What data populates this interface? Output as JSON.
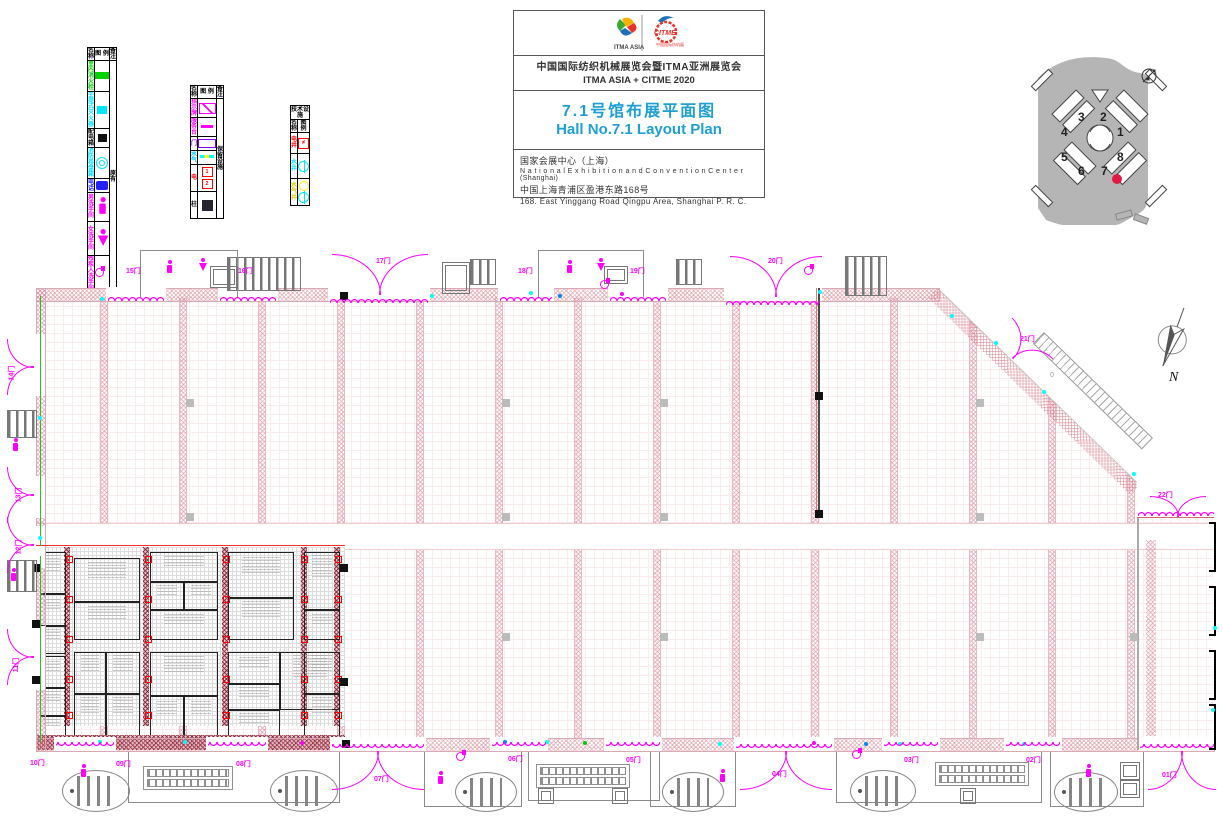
{
  "title_block": {
    "logo1": "ITMA ASIA",
    "logo2": "CITME",
    "line1_cn": "中国国际纺织机械展览会暨ITMA亚洲展览会",
    "line2_en": "ITMA ASIA + CITME 2020",
    "hall_cn": "7.1号馆布展平面图",
    "hall_en": "Hall No.7.1 Layout Plan",
    "venue_cn": "国家会展中心（上海）",
    "venue_en": "N a t i o n a l  E x h i b i t i o n  a n d  C o n v e n t i o n  C e n t e r  (Shanghai)",
    "addr_cn": "中国上海青浦区盈港东路168号",
    "addr_en": "168. East Yinggang Road Qingpu Area, Shanghai P. R. C."
  },
  "compass_label": "N",
  "ramp_marker": "0",
  "legend": {
    "t1": {
      "h1": "名  称",
      "h2": "图  例",
      "h3": "备 注",
      "remark": "原 有",
      "rows": [
        {
          "t": "室内消火栓",
          "c": "#00d400",
          "icon": "greenbox",
          "h": 11
        },
        {
          "t": "手提式灭火器",
          "c": "#00e5ff",
          "icon": "cyanbox",
          "h": 11
        },
        {
          "t": "配电箱",
          "c": "#111111",
          "icon": "blackbox",
          "h": 11
        },
        {
          "t": "消防卷盘箱",
          "c": "#00e5ff",
          "icon": "coil",
          "h": 13
        },
        {
          "t": "电话",
          "c": "#2222ff",
          "icon": "phone",
          "h": 13
        },
        {
          "t": "男洗手间",
          "c": "#ff00ff",
          "icon": "man",
          "h": 28
        },
        {
          "t": "女洗手间",
          "c": "#ff00ff",
          "icon": "woman",
          "h": 33
        },
        {
          "t": "残疾人洗手间",
          "c": "#ff00ff",
          "icon": "wheelchair",
          "h": 31
        }
      ]
    },
    "t2": {
      "h1": "名  称",
      "h2": "图  例",
      "h3": "备 注",
      "remark": "保留设施",
      "rows": [
        {
          "t": "指示牌",
          "c": "#ff00ff",
          "icon": "sign",
          "h": 16
        },
        {
          "t": "服务台",
          "c": "#ff00ff",
          "icon": "dashM",
          "h": 13
        },
        {
          "t": "门",
          "c": "#8000ff",
          "icon": "doorP",
          "h": 13
        },
        {
          "t": "水气",
          "c": "#00c8ff",
          "icon": "wg",
          "h": 13
        },
        {
          "t": "电",
          "c": "#ff0000",
          "icon": "elec2",
          "h": 26
        },
        {
          "t": "柱",
          "c": "#111111",
          "icon": "colblk",
          "h": 26
        }
      ]
    },
    "t3": {
      "title": "技术设施",
      "h1": "名 称",
      "h2": "图 例",
      "rows": [
        {
          "t": "电井",
          "c": "#ff0000",
          "icon": "wellE",
          "h": 20
        },
        {
          "t": "水井",
          "c": "#00e5ff",
          "icon": "wellW",
          "h": 24
        },
        {
          "t": "水气井",
          "c": "#ddcc00",
          "icon": "wellWG",
          "h": 26
        }
      ]
    }
  },
  "site_map": {
    "highlight_hall": "7",
    "red": "#e11a45",
    "halls": [
      {
        "n": "3",
        "x": 50,
        "y": 60
      },
      {
        "n": "2",
        "x": 72,
        "y": 60
      },
      {
        "n": "4",
        "x": 33,
        "y": 75
      },
      {
        "n": "1",
        "x": 89,
        "y": 75
      },
      {
        "n": "5",
        "x": 33,
        "y": 100
      },
      {
        "n": "8",
        "x": 89,
        "y": 100
      },
      {
        "n": "6",
        "x": 50,
        "y": 114
      },
      {
        "n": "7",
        "x": 73,
        "y": 114
      }
    ],
    "red_dot": {
      "x": 84,
      "y": 124
    }
  },
  "plan": {
    "door_labels": [
      [
        "15门",
        126,
        266,
        0
      ],
      [
        "16门",
        238,
        266,
        0
      ],
      [
        "17门",
        376,
        256,
        0
      ],
      [
        "18门",
        518,
        266,
        0
      ],
      [
        "19门",
        630,
        266,
        0
      ],
      [
        "20门",
        768,
        256,
        0
      ],
      [
        "21门",
        1020,
        334,
        0
      ],
      [
        "22门",
        1158,
        490,
        0
      ],
      [
        "10门",
        30,
        758,
        0
      ],
      [
        "09门",
        116,
        759,
        0
      ],
      [
        "08门",
        236,
        759,
        0
      ],
      [
        "07门",
        374,
        774,
        0
      ],
      [
        "06门",
        508,
        754,
        0
      ],
      [
        "05门",
        626,
        755,
        0
      ],
      [
        "04门",
        772,
        769,
        0
      ],
      [
        "03门",
        904,
        755,
        0
      ],
      [
        "02门",
        1026,
        755,
        0
      ],
      [
        "01门",
        1162,
        770,
        0
      ],
      [
        "14门",
        4,
        368,
        -90
      ],
      [
        "13门",
        11,
        490,
        -90
      ],
      [
        "12门",
        11,
        542,
        -90
      ],
      [
        "11门",
        9,
        660,
        -90
      ]
    ],
    "arc_doors": [
      [
        332,
        254,
        96,
        40,
        0
      ],
      [
        730,
        256,
        92,
        40,
        0
      ],
      [
        994,
        334,
        58,
        28,
        45
      ],
      [
        1150,
        496,
        56,
        20,
        0
      ],
      [
        332,
        752,
        92,
        38,
        180
      ],
      [
        740,
        752,
        92,
        38,
        180
      ],
      [
        1148,
        752,
        68,
        38,
        180
      ],
      [
        -8,
        354,
        56,
        26,
        -90
      ],
      [
        -8,
        482,
        56,
        26,
        -90
      ],
      [
        -8,
        532,
        56,
        26,
        -90
      ],
      [
        -8,
        644,
        56,
        26,
        -90
      ]
    ],
    "scallops": [
      [
        108,
        294,
        56,
        0
      ],
      [
        220,
        294,
        56,
        0
      ],
      [
        330,
        296,
        98,
        0
      ],
      [
        500,
        294,
        52,
        0
      ],
      [
        610,
        294,
        56,
        0
      ],
      [
        726,
        298,
        94,
        0
      ],
      [
        56,
        742,
        58,
        180
      ],
      [
        208,
        742,
        58,
        180
      ],
      [
        332,
        744,
        92,
        180
      ],
      [
        492,
        742,
        54,
        180
      ],
      [
        606,
        742,
        54,
        180
      ],
      [
        736,
        744,
        96,
        180
      ],
      [
        884,
        742,
        54,
        180
      ],
      [
        1006,
        742,
        54,
        180
      ],
      [
        1140,
        744,
        74,
        180
      ],
      [
        1138,
        509,
        76,
        0
      ]
    ],
    "strips_open": [
      64,
      143,
      222,
      301,
      380,
      459,
      538,
      617,
      696,
      775,
      854,
      933,
      1012,
      1091
    ],
    "strips_booth": [
      64,
      143,
      222,
      301,
      334
    ],
    "aisle": [
      0,
      235,
      1177,
      25
    ],
    "columns": [
      [
        186,
        399
      ],
      [
        502,
        399
      ],
      [
        660,
        399
      ],
      [
        976,
        399
      ],
      [
        186,
        513
      ],
      [
        502,
        513
      ],
      [
        660,
        513
      ],
      [
        976,
        513
      ],
      [
        502,
        633
      ],
      [
        660,
        633
      ],
      [
        976,
        633
      ],
      [
        1130,
        633
      ]
    ],
    "blacks": [
      [
        815,
        392
      ],
      [
        815,
        510
      ],
      [
        340,
        292
      ],
      [
        340,
        564
      ],
      [
        340,
        678
      ],
      [
        32,
        564
      ],
      [
        32,
        620
      ],
      [
        32,
        676
      ],
      [
        342,
        740
      ]
    ],
    "lines": [
      [
        36,
        545,
        309,
        1,
        "#ff2a2a"
      ],
      [
        816,
        288,
        1,
        230,
        "#e07979"
      ],
      [
        818,
        288,
        2,
        230,
        "#4a4a4a"
      ],
      [
        40,
        296,
        1,
        250,
        "#23c423"
      ],
      [
        40,
        556,
        1,
        186,
        "#23c423"
      ],
      [
        1137,
        518,
        2,
        232,
        "#a9a9a9"
      ],
      [
        1137,
        517,
        77,
        1,
        "#d66a7d"
      ]
    ],
    "booths": [
      [
        40,
        552,
        24,
        40
      ],
      [
        40,
        594,
        24,
        30
      ],
      [
        40,
        626,
        24,
        26
      ],
      [
        74,
        558,
        64,
        42
      ],
      [
        74,
        602,
        64,
        36
      ],
      [
        150,
        552,
        66,
        28
      ],
      [
        150,
        582,
        32,
        26
      ],
      [
        184,
        582,
        32,
        26
      ],
      [
        150,
        610,
        66,
        28
      ],
      [
        228,
        552,
        64,
        44
      ],
      [
        228,
        598,
        64,
        40
      ],
      [
        304,
        552,
        34,
        56
      ],
      [
        304,
        610,
        34,
        28
      ],
      [
        40,
        656,
        24,
        30
      ],
      [
        40,
        688,
        24,
        26
      ],
      [
        40,
        716,
        24,
        18
      ],
      [
        74,
        652,
        30,
        40
      ],
      [
        106,
        652,
        32,
        40
      ],
      [
        74,
        694,
        30,
        40
      ],
      [
        106,
        694,
        32,
        40
      ],
      [
        150,
        652,
        66,
        42
      ],
      [
        150,
        696,
        32,
        38
      ],
      [
        184,
        696,
        32,
        38
      ],
      [
        228,
        652,
        50,
        30
      ],
      [
        228,
        684,
        50,
        24
      ],
      [
        280,
        652,
        58,
        56
      ],
      [
        228,
        710,
        50,
        24
      ],
      [
        304,
        652,
        34,
        40
      ],
      [
        304,
        694,
        34,
        40
      ]
    ],
    "red_marks": {
      "xs": [
        66,
        145,
        223,
        301,
        335
      ],
      "ys": [
        556,
        596,
        636,
        676,
        712
      ]
    },
    "brackets": [
      [
        1209,
        522,
        46
      ],
      [
        1209,
        586,
        46
      ],
      [
        1209,
        650,
        46
      ],
      [
        1209,
        704,
        42
      ]
    ],
    "furniture": [
      [
        "stairs",
        227,
        257,
        72,
        32
      ],
      [
        "stairs",
        845,
        256,
        40,
        38
      ],
      [
        "stairs",
        470,
        259,
        24,
        24
      ],
      [
        "stairs",
        676,
        259,
        24,
        24
      ],
      [
        "stairs",
        7,
        410,
        28,
        26
      ],
      [
        "stairs",
        7,
        560,
        28,
        30
      ],
      [
        "lobbyT",
        140,
        250,
        96,
        46
      ],
      [
        "lobbyT",
        538,
        250,
        104,
        46
      ],
      [
        "lobbyB",
        128,
        752,
        210,
        50
      ],
      [
        "lobbyB",
        424,
        752,
        96,
        54
      ],
      [
        "lobbyB",
        528,
        752,
        130,
        48
      ],
      [
        "lobbyB",
        650,
        752,
        84,
        54
      ],
      [
        "lobbyB",
        836,
        752,
        204,
        50
      ],
      [
        "lobbyB",
        1050,
        752,
        92,
        54
      ],
      [
        "oval",
        62,
        770,
        66,
        40
      ],
      [
        "oval",
        270,
        770,
        66,
        40
      ],
      [
        "oval",
        455,
        772,
        60,
        38
      ],
      [
        "oval",
        662,
        772,
        60,
        38
      ],
      [
        "oval",
        850,
        770,
        64,
        40
      ],
      [
        "oval",
        1054,
        772,
        62,
        38
      ],
      [
        "esc",
        143,
        766,
        88,
        22
      ],
      [
        "esc",
        536,
        764,
        92,
        22
      ],
      [
        "esc",
        935,
        762,
        92,
        22
      ],
      [
        "elev",
        210,
        266,
        26,
        20
      ],
      [
        "elev",
        604,
        266,
        22,
        16
      ],
      [
        "elev",
        442,
        262,
        26,
        30
      ],
      [
        "elev",
        538,
        788,
        14,
        14
      ],
      [
        "elev",
        612,
        788,
        14,
        14
      ],
      [
        "elev",
        960,
        788,
        14,
        14
      ],
      [
        "elev",
        1120,
        762,
        18,
        16
      ],
      [
        "elev",
        1120,
        780,
        18,
        16
      ]
    ],
    "persons": [
      [
        166,
        260
      ],
      [
        199,
        258
      ],
      [
        566,
        260
      ],
      [
        597,
        258
      ],
      [
        80,
        764
      ],
      [
        437,
        771
      ],
      [
        719,
        769
      ],
      [
        1085,
        764
      ],
      [
        12,
        438
      ],
      [
        10,
        568
      ]
    ],
    "women": [
      [
        199,
        258
      ],
      [
        597,
        258
      ]
    ],
    "wheelchairs": [
      [
        456,
        750
      ],
      [
        852,
        748
      ],
      [
        600,
        278
      ],
      [
        804,
        264
      ]
    ],
    "dots": [
      [
        100,
        297,
        "#0ff"
      ],
      [
        430,
        294,
        "#0ff"
      ],
      [
        529,
        291,
        "#0ff"
      ],
      [
        558,
        294,
        "#08f"
      ],
      [
        620,
        292,
        "#f0f"
      ],
      [
        818,
        290,
        "#0ff"
      ],
      [
        950,
        314,
        "#0ff"
      ],
      [
        994,
        341,
        "#0ff"
      ],
      [
        1042,
        390,
        "#0ff"
      ],
      [
        183,
        740,
        "#0ff"
      ],
      [
        300,
        741,
        "#f0f"
      ],
      [
        503,
        740,
        "#08f"
      ],
      [
        545,
        740,
        "#0ff"
      ],
      [
        583,
        741,
        "#0c0"
      ],
      [
        718,
        742,
        "#0ff"
      ],
      [
        812,
        741,
        "#f0f"
      ],
      [
        864,
        742,
        "#08f"
      ],
      [
        898,
        742,
        "#0ff"
      ],
      [
        1022,
        742,
        "#0ff"
      ],
      [
        1213,
        626,
        "#0ff"
      ],
      [
        1211,
        708,
        "#0ff"
      ],
      [
        38,
        416,
        "#0ff"
      ],
      [
        38,
        536,
        "#0ff"
      ],
      [
        98,
        740,
        "#0ff"
      ],
      [
        1132,
        472,
        "#0ff"
      ]
    ],
    "top_wall": {
      "band": [
        36,
        288,
        902,
        12
      ],
      "gaps": [
        [
          106,
          60
        ],
        [
          218,
          60
        ],
        [
          328,
          102
        ],
        [
          498,
          56
        ],
        [
          608,
          60
        ],
        [
          724,
          98
        ]
      ]
    },
    "bottom_wall": {
      "band": [
        36,
        738,
        1177,
        12
      ],
      "gaps": [
        [
          54,
          62
        ],
        [
          206,
          62
        ],
        [
          330,
          96
        ],
        [
          490,
          58
        ],
        [
          604,
          58
        ],
        [
          734,
          100
        ],
        [
          882,
          58
        ],
        [
          1004,
          58
        ],
        [
          1138,
          76
        ]
      ]
    },
    "left_wall": {
      "band": [
        36,
        288,
        8,
        462
      ],
      "gaps": [
        [
          334,
          62
        ],
        [
          476,
          42
        ],
        [
          526,
          42
        ],
        [
          626,
          64
        ]
      ]
    }
  }
}
